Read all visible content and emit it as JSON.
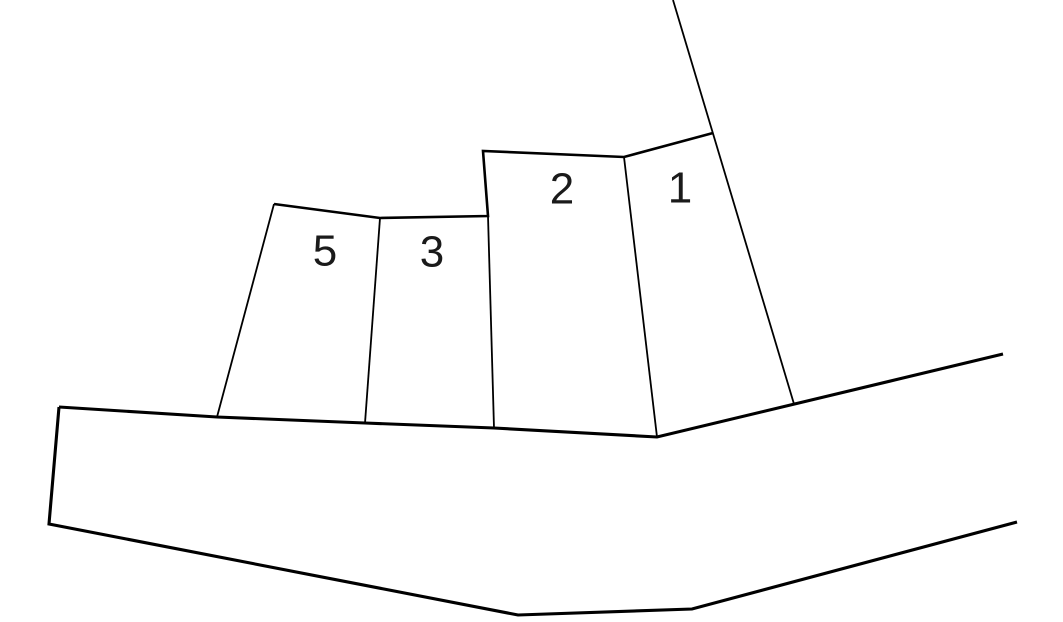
{
  "diagram": {
    "type": "land-parcel-sketch",
    "background_color": "#ffffff",
    "line_color": "#000000",
    "label_color": "#1a1a1a",
    "canvas": {
      "width": 1063,
      "height": 622
    },
    "parcels": [
      {
        "label": "1",
        "label_x": 680,
        "label_y": 188,
        "points": "624,157 713,133 794,404 657,437"
      },
      {
        "label": "2",
        "label_x": 562,
        "label_y": 189,
        "points": "483,151 624,157 657,437 494,428 487,217"
      },
      {
        "label": "3",
        "label_x": 432,
        "label_y": 252,
        "points": "380,218 488,216 494,428 365,423"
      },
      {
        "label": "5",
        "label_x": 325,
        "label_y": 251,
        "points": "274,204 380,218 365,423 217,417"
      }
    ],
    "road": {
      "top_edge_points": "59,407 217,417 365,423 494,428 657,437 1003,354",
      "left_bottom_edge_points": "59,407 49,524 518,615 692,609 1017,522",
      "region_points": "59,407 217,417 365,423 494,428 657,437 1003,354 1017,522 692,609 518,615 49,524"
    },
    "frontage_points": "274,204 380,218 488,216 483,151 624,157 713,133",
    "boundary_lines": [
      {
        "name": "parcel-5-left-boundary",
        "points": "274,204 217,417"
      },
      {
        "name": "parcel-5-3-divider",
        "points": "380,218 365,423"
      },
      {
        "name": "parcel-3-2-divider",
        "points": "488,216 494,428"
      },
      {
        "name": "parcel-2-1-divider",
        "points": "624,157 657,437"
      },
      {
        "name": "outer-boundary-diagonal",
        "points": "673,0 794,404"
      }
    ]
  }
}
